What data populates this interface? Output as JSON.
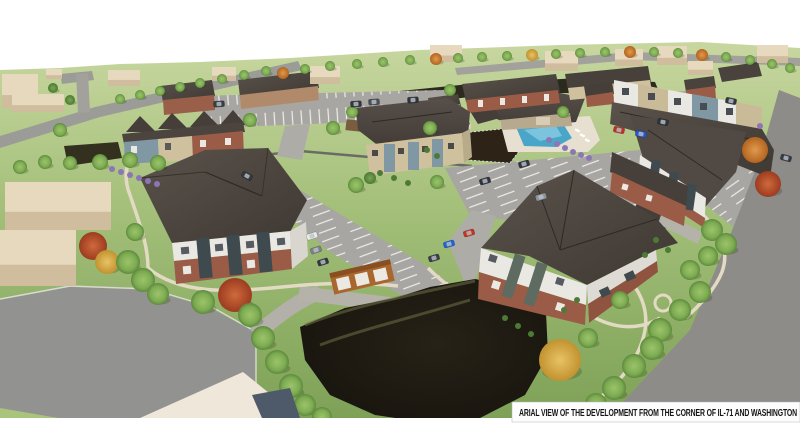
{
  "caption": {
    "text": "ARIAL VIEW  OF THE DEVELOPMENT FROM  THE CORNER OF IL-71 AND WASHINGTON"
  },
  "scene": {
    "description": "Aerial 3D architectural rendering of an apartment development: apartment buildings and townhomes with dark shingle roofs, clubhouse with pool, dog park, gazebo, garages, parking lots with cars, detention pond, walking paths, and surrounding streets",
    "palette": {
      "sky": "#ffffff",
      "grass_top": "#c8d7a0",
      "grass_bottom": "#7ea157",
      "road": "#9b9b98",
      "big_road": "#929290",
      "parking": "#a8a6a2",
      "drive": "#b3b0a9",
      "path": "#e3dac4",
      "roof_dark": "#4c4540",
      "brick": "#9a5c46",
      "siding_white": "#e9e8e3",
      "siding_tan": "#cfc19d",
      "panel_blue": "#7f98a4",
      "panel_sage": "#5d6b60",
      "pond": "#1c1913",
      "pool_water": "#4aa6c8",
      "pool_deck": "#e7e0d0",
      "berm_dark": "#2c2a1e",
      "mulch": "#2e2317",
      "garage_wall": "#a9672f",
      "context_building": "#e7d9be",
      "tree_green": "#7dab52",
      "tree_dark_green": "#5f8f41",
      "tree_orange": "#cc7c33",
      "tree_red": "#b44b2a",
      "tree_gold": "#d9a941",
      "shrub_purple": "#8d76b5",
      "caption_bg": "#fdfdfd"
    },
    "context_buildings": [
      [
        2,
        74,
        36,
        34
      ],
      [
        12,
        94,
        52,
        18
      ],
      [
        46,
        69,
        16,
        10
      ],
      [
        108,
        70,
        32,
        16
      ],
      [
        212,
        67,
        24,
        14
      ],
      [
        310,
        66,
        30,
        18
      ],
      [
        430,
        45,
        32,
        17
      ],
      [
        545,
        51,
        33,
        20
      ],
      [
        615,
        49,
        28,
        17
      ],
      [
        657,
        46,
        30,
        19
      ],
      [
        688,
        61,
        25,
        14
      ],
      [
        757,
        45,
        31,
        18
      ],
      [
        5,
        182,
        106,
        48
      ],
      [
        0,
        230,
        76,
        56
      ]
    ],
    "trees": [
      [
        120,
        99,
        5,
        "g"
      ],
      [
        140,
        95,
        5,
        "g"
      ],
      [
        160,
        91,
        5,
        "g"
      ],
      [
        180,
        87,
        5,
        "g"
      ],
      [
        200,
        83,
        5,
        "g"
      ],
      [
        222,
        79,
        5,
        "g"
      ],
      [
        244,
        75,
        5,
        "g"
      ],
      [
        266,
        71,
        5,
        "g"
      ],
      [
        283,
        73,
        6,
        "o"
      ],
      [
        305,
        69,
        5,
        "g"
      ],
      [
        330,
        66,
        5,
        "g"
      ],
      [
        357,
        64,
        5,
        "g"
      ],
      [
        383,
        62,
        5,
        "g"
      ],
      [
        410,
        60,
        5,
        "g"
      ],
      [
        436,
        59,
        6,
        "o"
      ],
      [
        458,
        58,
        5,
        "g"
      ],
      [
        482,
        57,
        5,
        "g"
      ],
      [
        507,
        56,
        5,
        "g"
      ],
      [
        532,
        55,
        6,
        "y"
      ],
      [
        556,
        54,
        5,
        "g"
      ],
      [
        580,
        53,
        5,
        "g"
      ],
      [
        605,
        52,
        5,
        "g"
      ],
      [
        630,
        52,
        6,
        "o"
      ],
      [
        654,
        52,
        5,
        "g"
      ],
      [
        678,
        53,
        5,
        "g"
      ],
      [
        702,
        55,
        6,
        "o"
      ],
      [
        726,
        57,
        5,
        "g"
      ],
      [
        750,
        60,
        5,
        "g"
      ],
      [
        772,
        64,
        5,
        "g"
      ],
      [
        790,
        68,
        5,
        "g"
      ],
      [
        20,
        167,
        7,
        "g"
      ],
      [
        45,
        162,
        7,
        "g"
      ],
      [
        70,
        163,
        7,
        "g"
      ],
      [
        100,
        162,
        8,
        "g"
      ],
      [
        130,
        160,
        8,
        "g"
      ],
      [
        158,
        163,
        8,
        "g"
      ],
      [
        53,
        88,
        5,
        "d"
      ],
      [
        70,
        100,
        5,
        "d"
      ],
      [
        93,
        246,
        14,
        "r"
      ],
      [
        107,
        262,
        12,
        "y"
      ],
      [
        128,
        262,
        12,
        "g"
      ],
      [
        143,
        280,
        12,
        "g"
      ],
      [
        158,
        294,
        11,
        "g"
      ],
      [
        135,
        232,
        9,
        "g"
      ],
      [
        203,
        302,
        12,
        "g"
      ],
      [
        235,
        295,
        17,
        "r"
      ],
      [
        250,
        315,
        12,
        "g"
      ],
      [
        263,
        338,
        12,
        "g"
      ],
      [
        277,
        362,
        12,
        "g"
      ],
      [
        291,
        386,
        12,
        "g"
      ],
      [
        305,
        405,
        11,
        "g"
      ],
      [
        322,
        417,
        10,
        "g"
      ],
      [
        250,
        120,
        7,
        "g"
      ],
      [
        333,
        128,
        7,
        "g"
      ],
      [
        352,
        112,
        6,
        "g"
      ],
      [
        430,
        128,
        7,
        "g"
      ],
      [
        450,
        90,
        6,
        "g"
      ],
      [
        563,
        112,
        6,
        "g"
      ],
      [
        356,
        185,
        8,
        "g"
      ],
      [
        370,
        178,
        6,
        "d"
      ],
      [
        437,
        182,
        7,
        "g"
      ],
      [
        755,
        150,
        13,
        "o"
      ],
      [
        768,
        184,
        13,
        "r"
      ],
      [
        712,
        230,
        11,
        "g"
      ],
      [
        726,
        244,
        11,
        "g"
      ],
      [
        708,
        256,
        10,
        "g"
      ],
      [
        690,
        270,
        10,
        "g"
      ],
      [
        700,
        292,
        11,
        "g"
      ],
      [
        680,
        310,
        11,
        "g"
      ],
      [
        660,
        330,
        12,
        "g"
      ],
      [
        652,
        348,
        12,
        "g"
      ],
      [
        634,
        366,
        12,
        "g"
      ],
      [
        614,
        388,
        12,
        "g"
      ],
      [
        596,
        404,
        11,
        "g"
      ],
      [
        560,
        360,
        21,
        "y"
      ],
      [
        588,
        338,
        10,
        "g"
      ],
      [
        620,
        300,
        9,
        "g"
      ],
      [
        60,
        130,
        7,
        "g"
      ]
    ],
    "shrubs": [
      [
        549,
        140,
        "p"
      ],
      [
        557,
        144,
        "p"
      ],
      [
        565,
        148,
        "p"
      ],
      [
        573,
        152,
        "p"
      ],
      [
        581,
        155,
        "p"
      ],
      [
        589,
        158,
        "p"
      ],
      [
        760,
        126,
        "p"
      ],
      [
        112,
        169,
        "p"
      ],
      [
        121,
        172,
        "p"
      ],
      [
        130,
        175,
        "p"
      ],
      [
        139,
        178,
        "p"
      ],
      [
        148,
        181,
        "p"
      ],
      [
        157,
        184,
        "p"
      ],
      [
        427,
        150,
        "d"
      ],
      [
        437,
        156,
        "d"
      ],
      [
        380,
        173,
        "d"
      ],
      [
        394,
        178,
        "d"
      ],
      [
        408,
        183,
        "d"
      ],
      [
        505,
        318,
        "d"
      ],
      [
        518,
        326,
        "d"
      ],
      [
        531,
        334,
        "d"
      ],
      [
        656,
        240,
        "d"
      ],
      [
        668,
        250,
        "d"
      ],
      [
        645,
        255,
        "d"
      ],
      [
        577,
        300,
        "d"
      ],
      [
        564,
        310,
        "d"
      ]
    ],
    "cars": [
      [
        356,
        104,
        -4,
        "#32363c"
      ],
      [
        374,
        102,
        -4,
        "#4a4f57"
      ],
      [
        413,
        100,
        -4,
        "#2f333a"
      ],
      [
        219,
        104,
        -4,
        "#383c44"
      ],
      [
        247,
        176,
        28,
        "#33373e"
      ],
      [
        312,
        236,
        -18,
        "#e9e9e7"
      ],
      [
        316,
        250,
        -18,
        "#7c8187"
      ],
      [
        323,
        262,
        -18,
        "#33373e"
      ],
      [
        449,
        244,
        -16,
        "#1f63d6"
      ],
      [
        469,
        233,
        -16,
        "#c23526"
      ],
      [
        434,
        258,
        -16,
        "#3a3e45"
      ],
      [
        485,
        181,
        -16,
        "#2f333a"
      ],
      [
        541,
        197,
        -16,
        "#8e9399"
      ],
      [
        524,
        164,
        -16,
        "#33373e"
      ],
      [
        641,
        134,
        12,
        "#2857c9"
      ],
      [
        619,
        130,
        12,
        "#b83227"
      ],
      [
        663,
        122,
        12,
        "#2f333a"
      ],
      [
        731,
        101,
        12,
        "#33373e"
      ],
      [
        786,
        158,
        15,
        "#383c44"
      ]
    ]
  }
}
